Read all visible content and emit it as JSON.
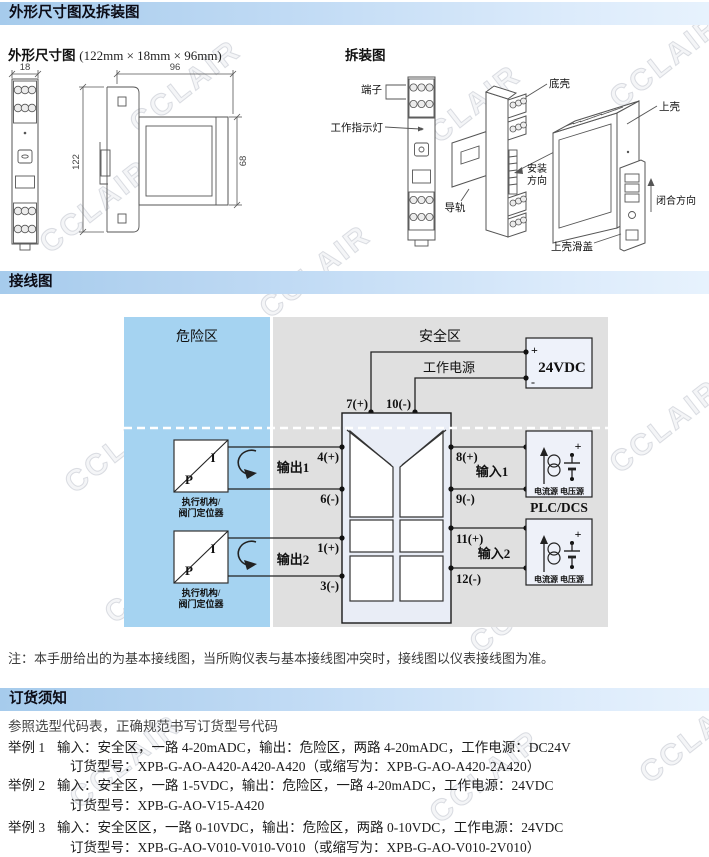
{
  "watermark": "CCLAIR",
  "headers": {
    "section1": "外形尺寸图及拆装图",
    "section2": "接线图",
    "section3": "订货须知"
  },
  "dimension_figure": {
    "title": "外形尺寸图",
    "size": "(122mm × 18mm × 96mm)",
    "dim_width": "18",
    "dim_depth": "96",
    "dim_height": "122",
    "dim_face": "68"
  },
  "disassembly_figure": {
    "title": "拆装图",
    "terminal": "端子",
    "indicator": "工作指示灯",
    "rail": "导轨",
    "bottom_shell": "底壳",
    "top_shell": "上壳",
    "install_dir_1": "安装",
    "install_dir_2": "方向",
    "close_dir": "闭合方向",
    "slide_cover": "上壳滑盖"
  },
  "wiring": {
    "hazard_zone": "危险区",
    "safe_zone": "安全区",
    "power_label": "工作电源",
    "power_value": "24VDC",
    "plus": "+",
    "minus": "-",
    "t7": "7(+)",
    "t10": "10(-)",
    "out1": {
      "label": "输出1",
      "pos": "4(+)",
      "neg": "6(-)"
    },
    "out2": {
      "label": "输出2",
      "pos": "1(+)",
      "neg": "3(-)"
    },
    "in1": {
      "label": "输入1",
      "pos": "8(+)",
      "neg": "9(-)"
    },
    "in2": {
      "label": "输入2",
      "pos": "11(+)",
      "neg": "12(-)"
    },
    "pi_p": "P",
    "pi_i": "I",
    "actuator_line1": "执行机构/",
    "actuator_line2": "阀门定位器",
    "source_label": "电流源 电压源",
    "plc_label": "PLC/DCS"
  },
  "note": "注：本手册给出的为基本接线图，当所购仪表与基本接线图冲突时，接线图以仪表接线图为准。",
  "ordering": {
    "intro": "参照选型代码表，正确规范书写订货型号代码",
    "examples": [
      {
        "tag": "举例 1",
        "desc": "输入：安全区，一路 4-20mADC，输出：危险区，两路 4-20mADC，工作电源：DC24V",
        "model": "订货型号：XPB-G-AO-A420-A420-A420（或缩写为：XPB-G-AO-A420-2A420）"
      },
      {
        "tag": "举例 2",
        "desc": "输入：安全区，一路 1-5VDC，输出：危险区，一路 4-20mADC，工作电源：24VDC",
        "model": "订货型号：XPB-G-AO-V15-A420"
      },
      {
        "tag": "举例 3",
        "desc": "输入：安全区区，一路 0-10VDC，输出：危险区，两路 0-10VDC，工作电源：24VDC",
        "model": "订货型号：XPB-G-AO-V010-V010-V010（或缩写为：XPB-G-AO-V010-2V010）"
      }
    ]
  },
  "colors": {
    "header_grad_start": "#a6cbec",
    "header_grad_end": "#e7f2fd",
    "hazard_fill": "#a5d3f1",
    "safe_fill": "#e0e0e0",
    "device_fill": "#e9edf6",
    "box_fill": "#eef1f9"
  }
}
